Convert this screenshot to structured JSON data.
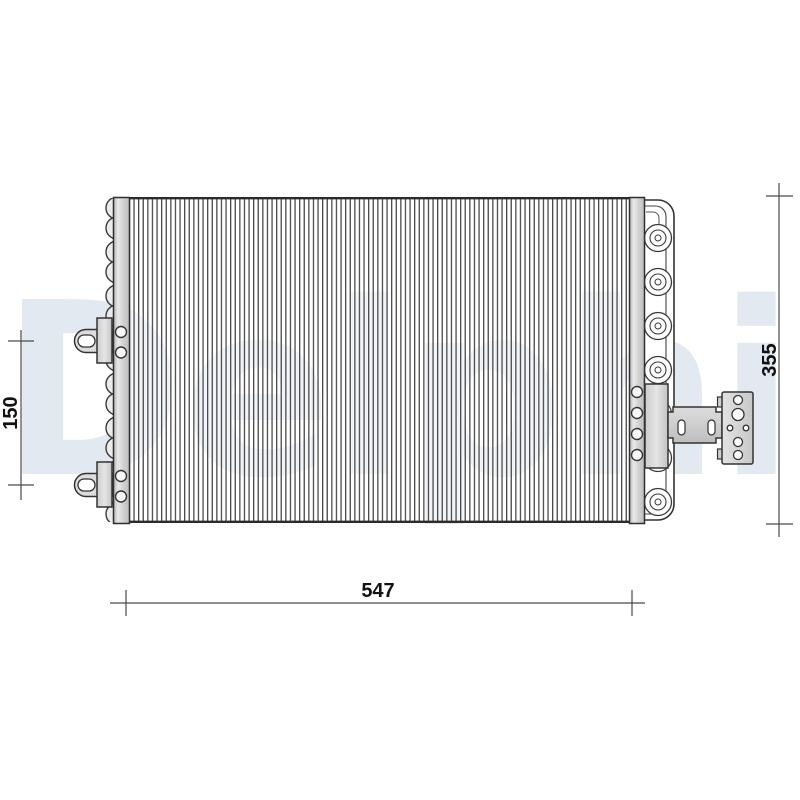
{
  "watermark": {
    "text": "Delphi"
  },
  "dimensions": {
    "width": {
      "value": "547",
      "orientation": "horizontal",
      "position": "bottom"
    },
    "height": {
      "value": "355",
      "orientation": "vertical",
      "position": "right"
    },
    "bracket_spacing": {
      "value": "150",
      "orientation": "vertical",
      "position": "left"
    }
  },
  "colors": {
    "background": "#ffffff",
    "watermark": "#e3e9f0",
    "outline": "#333333",
    "fin_line": "#4a4a4a",
    "dimension_line": "#4a4a4a",
    "dimension_text": "#111111",
    "part_fill_light": "#d9d9d9",
    "hole_fill": "#f7f7f7"
  },
  "drawing": {
    "core_fin_count": 109,
    "left_bracket_count": 2,
    "right_coil_count": 7,
    "side_plate_hole_count": 4,
    "connector_hole_count": 6
  }
}
